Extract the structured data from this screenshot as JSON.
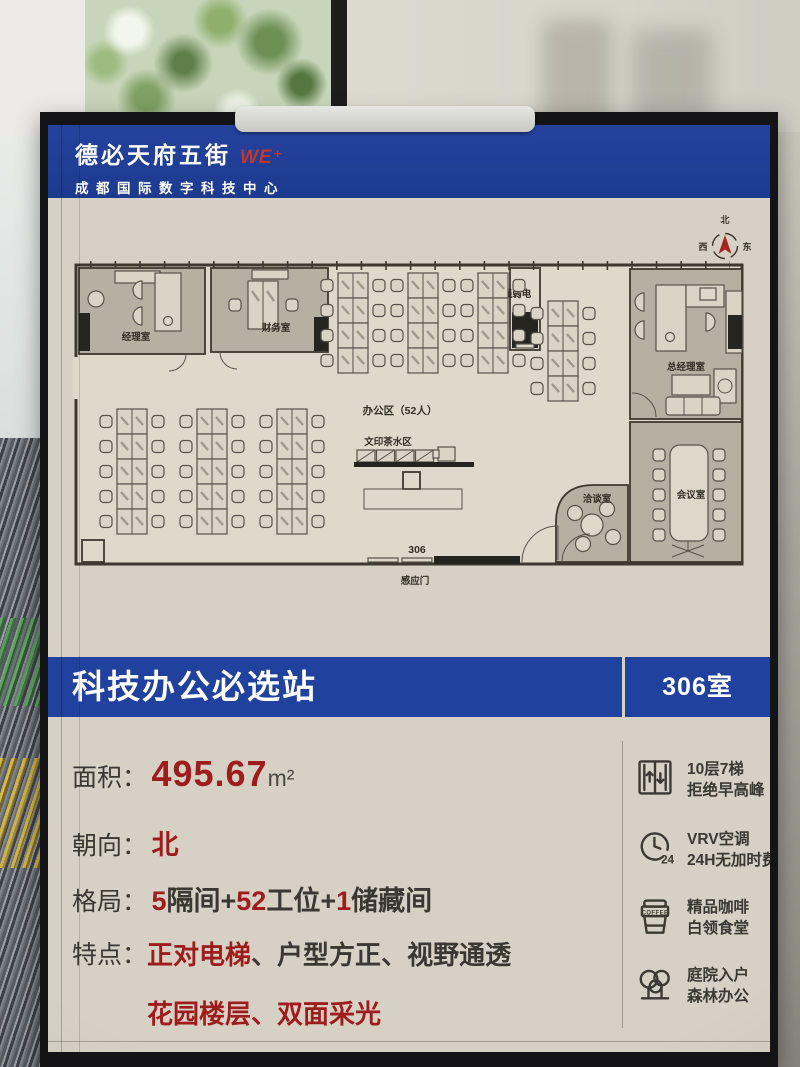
{
  "header": {
    "brand": "德必天府五街",
    "logo": "WE⁺",
    "subtitle": "成都国际数字科技中心"
  },
  "compass": {
    "n": "北",
    "s": "南",
    "w": "西",
    "e": "东"
  },
  "floorplan": {
    "rooms": {
      "manager": "经理室",
      "finance": "财务室",
      "electrical": "强弱电",
      "gm": "总经理室",
      "meeting": "会议室",
      "negotiation": "洽谈室"
    },
    "labels": {
      "office_area": "办公区（52人）",
      "print_tea": "文印茶水区",
      "room_number": "306",
      "sensor_door": "感应门"
    }
  },
  "banner": {
    "title": "科技办公必选站",
    "room": "306室"
  },
  "specs": {
    "area": {
      "label": "面积：",
      "value": "495.67",
      "unit": "m²"
    },
    "orientation": {
      "label": "朝向：",
      "value": "北"
    },
    "layout": {
      "label": "格局：",
      "parts": [
        "5",
        "隔间+",
        "52",
        "工位+",
        "1",
        "储藏间"
      ]
    },
    "features": {
      "label": "特点：",
      "f1": "正对电梯",
      "d1": "、",
      "f2": "户型方正",
      "d2": "、",
      "f3": "视野通透",
      "f4": "花园楼层",
      "d3": "、",
      "f5": "双面采光"
    }
  },
  "amenities": [
    {
      "name": "elevator",
      "line1": "10层7梯",
      "line2": "拒绝早高峰"
    },
    {
      "name": "aircon",
      "badge": "24",
      "line1": "VRV空调",
      "line2": "24H无加时费"
    },
    {
      "name": "coffee",
      "badge": "COFFEE",
      "line1": "精品咖啡",
      "line2": "白领食堂"
    },
    {
      "name": "garden",
      "line1": "庭院入户",
      "line2": "森林办公"
    }
  ],
  "colors": {
    "accent_blue": "#20419d",
    "accent_red": "#9e1c1c",
    "poster_beige": "#d6d1c4"
  }
}
